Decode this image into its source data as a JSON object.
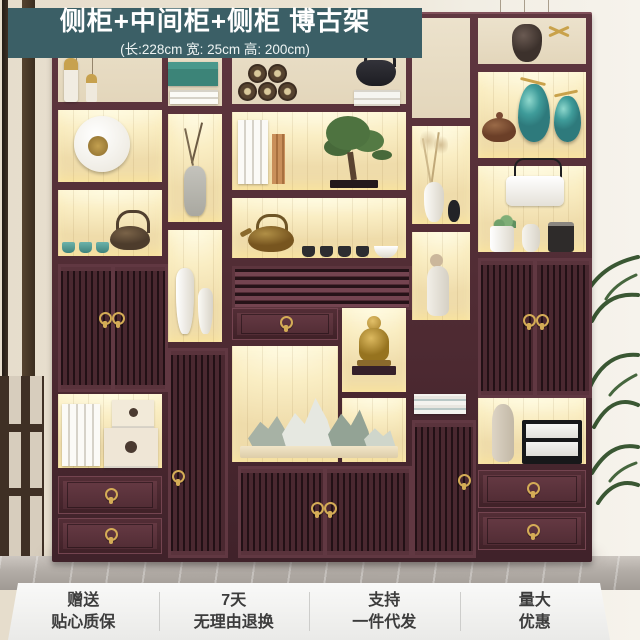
{
  "banner": {
    "title": "侧柜+中间柜+侧柜 博古架",
    "subtitle": "(长:228cm 宽: 25cm 高: 200cm)"
  },
  "services": {
    "items": [
      {
        "line1": "赠送",
        "line2": "贴心质保"
      },
      {
        "line1": "7天",
        "line2": "无理由退换"
      },
      {
        "line1": "支持",
        "line2": "一件代发"
      },
      {
        "line1": "量大",
        "line2": "优惠"
      }
    ]
  },
  "palette": {
    "banner_bg": "#3b5f66",
    "banner_text": "#ffffff",
    "wood_frame": "#4f2b33",
    "wood_light": "#6d3f48",
    "niche_glow": "#f9ecc0",
    "backdrop_cream": "#ece2cc",
    "brass_handle": "#d4ac56",
    "ceramic_teal": "#3f9c9a",
    "service_bar_bg": "#f2f2f0",
    "service_text": "#3c3c3c",
    "floor_gray": "#aba5a0",
    "wall_cream": "#ece5d5",
    "plant_green": "#3a5733"
  }
}
